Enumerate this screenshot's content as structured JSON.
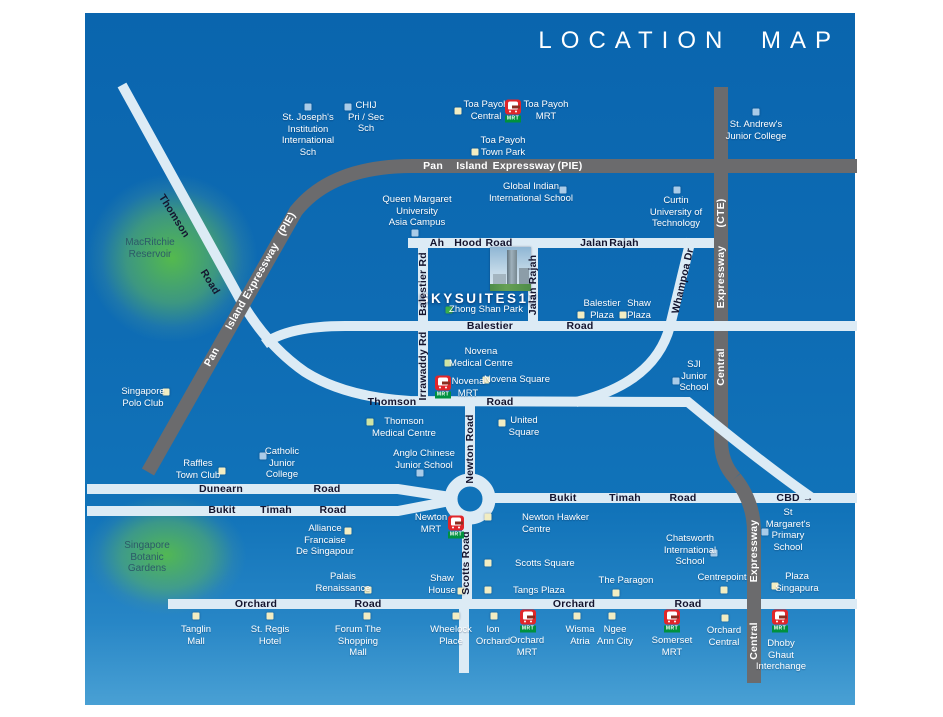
{
  "title": "LOCATION MAP",
  "project": {
    "name": "SKYSUITES17"
  },
  "mrt_badge": "MRT",
  "colors": {
    "background": "#0e6cb4",
    "road_minor": "#dcebf5",
    "expressway": "#6b6b6d",
    "marker_mall": "#f2edc2",
    "marker_school": "#a9cbe8",
    "marker_park": "#3bae4b",
    "marker_medical": "#cfe4a3",
    "mrt_red": "#e0262a",
    "mrt_green": "#00913e",
    "road_text": "#14142e",
    "label_text": "#ffffff",
    "green_area_text": "#2c5a68"
  },
  "map": {
    "green_areas": [
      {
        "id": "macritchie-reservoir",
        "lines": [
          "MacRitchie",
          "Reservoir"
        ],
        "x": 150,
        "y": 243
      },
      {
        "id": "singapore-botanic-gardens",
        "lines": [
          "Singapore",
          "Botanic",
          "Gardens"
        ],
        "x": 147,
        "y": 546
      }
    ],
    "road_labels": [
      {
        "t": "Pan",
        "x": 433,
        "y": 166,
        "c": "w"
      },
      {
        "t": "Island",
        "x": 472,
        "y": 166,
        "c": "w"
      },
      {
        "t": "Expressway",
        "x": 524,
        "y": 166,
        "c": "w"
      },
      {
        "t": "(PIE)",
        "x": 570,
        "y": 166,
        "c": "w"
      },
      {
        "t": "Pan",
        "x": 212,
        "y": 357,
        "rot": -61,
        "c": "w"
      },
      {
        "t": "Island",
        "x": 236,
        "y": 315,
        "rot": -61,
        "c": "w"
      },
      {
        "t": "Expressway",
        "x": 261,
        "y": 271,
        "rot": -61,
        "c": "w"
      },
      {
        "t": "(PIE)",
        "x": 287,
        "y": 224,
        "rot": -61,
        "c": "w"
      },
      {
        "t": "(CTE)",
        "x": 721,
        "y": 213,
        "rot": -90,
        "c": "w"
      },
      {
        "t": "Expressway",
        "x": 721,
        "y": 277,
        "rot": -90,
        "c": "w"
      },
      {
        "t": "Central",
        "x": 721,
        "y": 367,
        "rot": -90,
        "c": "w"
      },
      {
        "t": "Expressway",
        "x": 754,
        "y": 551,
        "rot": -90,
        "c": "w"
      },
      {
        "t": "Central",
        "x": 754,
        "y": 641,
        "rot": -90,
        "c": "w"
      },
      {
        "t": "Thomson",
        "x": 174,
        "y": 216,
        "rot": 58
      },
      {
        "t": "Road",
        "x": 210,
        "y": 282,
        "rot": 58
      },
      {
        "t": "Ah",
        "x": 437,
        "y": 243
      },
      {
        "t": "Hood",
        "x": 468,
        "y": 243
      },
      {
        "t": "Road",
        "x": 499,
        "y": 243
      },
      {
        "t": "Jalan",
        "x": 594,
        "y": 243
      },
      {
        "t": "Rajah",
        "x": 624,
        "y": 243
      },
      {
        "t": "Balestier Rd",
        "x": 423,
        "y": 284,
        "rot": -90
      },
      {
        "t": "Jalan Rajah",
        "x": 533,
        "y": 285,
        "rot": -90
      },
      {
        "t": "Whampoa Dr",
        "x": 683,
        "y": 281,
        "rot": -77
      },
      {
        "t": "Balestier",
        "x": 490,
        "y": 326
      },
      {
        "t": "Road",
        "x": 580,
        "y": 326
      },
      {
        "t": "Irrawaddy Rd",
        "x": 423,
        "y": 366,
        "rot": -90
      },
      {
        "t": "Thomson",
        "x": 392,
        "y": 402
      },
      {
        "t": "Road",
        "x": 500,
        "y": 402
      },
      {
        "t": "Newton Road",
        "x": 470,
        "y": 449,
        "rot": -90
      },
      {
        "t": "Dunearn",
        "x": 221,
        "y": 489
      },
      {
        "t": "Road",
        "x": 327,
        "y": 489
      },
      {
        "t": "Bukit",
        "x": 222,
        "y": 510
      },
      {
        "t": "Timah",
        "x": 276,
        "y": 510
      },
      {
        "t": "Road",
        "x": 333,
        "y": 510
      },
      {
        "t": "Bukit",
        "x": 563,
        "y": 498
      },
      {
        "t": "Timah",
        "x": 625,
        "y": 498
      },
      {
        "t": "Road",
        "x": 683,
        "y": 498
      },
      {
        "t": "CBD →",
        "x": 795,
        "y": 498
      },
      {
        "t": "Scotts Road",
        "x": 466,
        "y": 563,
        "rot": -90
      },
      {
        "t": "Orchard",
        "x": 256,
        "y": 604
      },
      {
        "t": "Road",
        "x": 368,
        "y": 604
      },
      {
        "t": "Orchard",
        "x": 574,
        "y": 604
      },
      {
        "t": "Road",
        "x": 688,
        "y": 604
      }
    ],
    "places": [
      {
        "id": "st-josephs-institution",
        "lines": [
          "St. Joseph's",
          "Institution",
          "International",
          "Sch"
        ],
        "x": 308,
        "y": 118,
        "mx": 308,
        "my": 107,
        "mc": "school"
      },
      {
        "id": "chij-pri-sec-sch",
        "lines": [
          "CHIJ",
          "Pri / Sec",
          "Sch"
        ],
        "x": 366,
        "y": 106,
        "mx": 348,
        "my": 107,
        "mc": "school"
      },
      {
        "id": "toa-payoh-central",
        "lines": [
          "Toa Payoh",
          "Central"
        ],
        "x": 486,
        "y": 105,
        "mx": 458,
        "my": 111,
        "mc": "mall"
      },
      {
        "id": "toa-payoh-town-park",
        "lines": [
          "Toa Payoh",
          "Town Park"
        ],
        "x": 503,
        "y": 141,
        "mx": 475,
        "my": 152,
        "mc": "mall"
      },
      {
        "id": "st-andrews-junior-college",
        "lines": [
          "St. Andrew's",
          "Junior College"
        ],
        "x": 756,
        "y": 125,
        "mx": 756,
        "my": 112,
        "mc": "school"
      },
      {
        "id": "global-indian-international-school",
        "lines": [
          "Global Indian",
          "International School"
        ],
        "x": 531,
        "y": 187,
        "mx": 563,
        "my": 190,
        "mc": "school"
      },
      {
        "id": "curtin-university-of-technology",
        "lines": [
          "Curtin",
          "University of",
          "Technology"
        ],
        "x": 676,
        "y": 201,
        "mx": 677,
        "my": 190,
        "mc": "school"
      },
      {
        "id": "queen-margaret-university",
        "lines": [
          "Queen Margaret",
          "University",
          "Asia Campus"
        ],
        "x": 417,
        "y": 200,
        "mx": 415,
        "my": 233,
        "mc": "school"
      },
      {
        "id": "balestier-plaza",
        "lines": [
          "Balestier",
          "Plaza"
        ],
        "x": 602,
        "y": 304,
        "mx": 581,
        "my": 315,
        "mc": "mall"
      },
      {
        "id": "shaw-plaza",
        "lines": [
          "Shaw",
          "Plaza"
        ],
        "x": 639,
        "y": 304,
        "mx": 623,
        "my": 315,
        "mc": "mall"
      },
      {
        "id": "zhong-shan-park",
        "lines": [
          "Zhong Shan Park"
        ],
        "x": 486,
        "y": 310,
        "mx": 449,
        "my": 310,
        "mc": "park"
      },
      {
        "id": "novena-medical-centre",
        "lines": [
          "Novena",
          "Medical Centre"
        ],
        "x": 481,
        "y": 352,
        "mx": 448,
        "my": 363,
        "mc": "medical"
      },
      {
        "id": "novena-square",
        "lines": [
          "Novena Square"
        ],
        "x": 517,
        "y": 380,
        "mx": 486,
        "my": 380,
        "mc": "mall"
      },
      {
        "id": "sji-junior-school",
        "lines": [
          "SJI",
          "Junior",
          "School"
        ],
        "x": 694,
        "y": 365,
        "mx": 676,
        "my": 381,
        "mc": "school"
      },
      {
        "id": "thomson-medical-centre",
        "lines": [
          "Thomson",
          "Medical Centre"
        ],
        "x": 404,
        "y": 422,
        "mx": 370,
        "my": 422,
        "mc": "medical"
      },
      {
        "id": "united-square",
        "lines": [
          "United",
          "Square"
        ],
        "x": 524,
        "y": 421,
        "mx": 502,
        "my": 423,
        "mc": "mall"
      },
      {
        "id": "anglo-chinese-junior-school",
        "lines": [
          "Anglo Chinese",
          "Junior School"
        ],
        "x": 424,
        "y": 454,
        "mx": 420,
        "my": 473,
        "mc": "school"
      },
      {
        "id": "newton-hawker-centre",
        "lines": [
          "Newton Hawker",
          "Centre"
        ],
        "x": 522,
        "y": 518,
        "align": "left",
        "mx": 488,
        "my": 517,
        "mc": "mall"
      },
      {
        "id": "scotts-square",
        "lines": [
          "Scotts Square"
        ],
        "x": 515,
        "y": 564,
        "align": "left",
        "mx": 488,
        "my": 563,
        "mc": "mall"
      },
      {
        "id": "tangs-plaza",
        "lines": [
          "Tangs Plaza"
        ],
        "x": 513,
        "y": 591,
        "align": "left",
        "mx": 488,
        "my": 590,
        "mc": "mall"
      },
      {
        "id": "shaw-house",
        "lines": [
          "Shaw",
          "House"
        ],
        "x": 442,
        "y": 579,
        "mx": 461,
        "my": 591,
        "mc": "mall"
      },
      {
        "id": "the-paragon",
        "lines": [
          "The Paragon"
        ],
        "x": 626,
        "y": 581,
        "mx": 616,
        "my": 593,
        "mc": "mall"
      },
      {
        "id": "centrepoint",
        "lines": [
          "Centrepoint"
        ],
        "x": 722,
        "y": 578,
        "mx": 724,
        "my": 590,
        "mc": "mall"
      },
      {
        "id": "chatsworth-international-school",
        "lines": [
          "Chatsworth",
          "International",
          "School"
        ],
        "x": 690,
        "y": 539,
        "mx": 714,
        "my": 553,
        "mc": "school"
      },
      {
        "id": "st-margarets-primary-school",
        "lines": [
          "St",
          "Margaret's",
          "Primary",
          "School"
        ],
        "x": 788,
        "y": 513,
        "mx": 765,
        "my": 532,
        "mc": "school"
      },
      {
        "id": "plaza-singapura",
        "lines": [
          "Plaza",
          "Singapura"
        ],
        "x": 797,
        "y": 577,
        "mx": 775,
        "my": 586,
        "mc": "mall"
      },
      {
        "id": "raffles-town-club",
        "lines": [
          "Raffles",
          "Town Club"
        ],
        "x": 198,
        "y": 464,
        "mx": 222,
        "my": 471,
        "mc": "mall"
      },
      {
        "id": "catholic-junior-college",
        "lines": [
          "Catholic",
          "Junior",
          "College"
        ],
        "x": 282,
        "y": 452,
        "mx": 263,
        "my": 456,
        "mc": "school"
      },
      {
        "id": "alliance-francaise-de-singapour",
        "lines": [
          "Alliance",
          "Francaise",
          "De Singapour"
        ],
        "x": 325,
        "y": 529,
        "mx": 348,
        "my": 531,
        "mc": "mall"
      },
      {
        "id": "palais-renaissance",
        "lines": [
          "Palais",
          "Renaissance"
        ],
        "x": 343,
        "y": 577,
        "mx": 368,
        "my": 590,
        "mc": "mall"
      },
      {
        "id": "singapore-polo-club",
        "lines": [
          "Singapore",
          "Polo Club"
        ],
        "x": 143,
        "y": 392,
        "mx": 166,
        "my": 392,
        "mc": "mall"
      },
      {
        "id": "tanglin-mall",
        "lines": [
          "Tanglin",
          "Mall"
        ],
        "x": 196,
        "y": 630,
        "mx": 196,
        "my": 616,
        "mc": "mall"
      },
      {
        "id": "st-regis-hotel",
        "lines": [
          "St. Regis",
          "Hotel"
        ],
        "x": 270,
        "y": 630,
        "mx": 270,
        "my": 616,
        "mc": "mall"
      },
      {
        "id": "forum-the-shopping-mall",
        "lines": [
          "Forum The",
          "Shopping",
          "Mall"
        ],
        "x": 358,
        "y": 630,
        "mx": 367,
        "my": 616,
        "mc": "mall"
      },
      {
        "id": "wheelock-place",
        "lines": [
          "Wheelock",
          "Place"
        ],
        "x": 451,
        "y": 630,
        "mx": 456,
        "my": 616,
        "mc": "mall"
      },
      {
        "id": "ion-orchard",
        "lines": [
          "Ion",
          "Orchard"
        ],
        "x": 493,
        "y": 630,
        "mx": 494,
        "my": 616,
        "mc": "mall"
      },
      {
        "id": "wisma-atria",
        "lines": [
          "Wisma",
          "Atria"
        ],
        "x": 580,
        "y": 630,
        "mx": 577,
        "my": 616,
        "mc": "mall"
      },
      {
        "id": "ngee-ann-city",
        "lines": [
          "Ngee",
          "Ann City"
        ],
        "x": 615,
        "y": 630,
        "mx": 612,
        "my": 616,
        "mc": "mall"
      },
      {
        "id": "orchard-central",
        "lines": [
          "Orchard",
          "Central"
        ],
        "x": 724,
        "y": 631,
        "mx": 725,
        "my": 618,
        "mc": "mall"
      }
    ],
    "mrt_stations": [
      {
        "id": "toa-payoh-mrt",
        "lines": [
          "Toa Payoh",
          "MRT"
        ],
        "ix": 513,
        "iy": 111,
        "lx": 546,
        "ly": 105
      },
      {
        "id": "novena-mrt",
        "lines": [
          "Novena",
          "MRT"
        ],
        "ix": 443,
        "iy": 387,
        "lx": 468,
        "ly": 382
      },
      {
        "id": "newton-mrt",
        "lines": [
          "Newton",
          "MRT"
        ],
        "ix": 456,
        "iy": 527,
        "lx": 431,
        "ly": 518
      },
      {
        "id": "orchard-mrt",
        "lines": [
          "Orchard",
          "MRT"
        ],
        "ix": 528,
        "iy": 621,
        "lx": 527,
        "ly": 641
      },
      {
        "id": "somerset-mrt",
        "lines": [
          "Somerset",
          "MRT"
        ],
        "ix": 672,
        "iy": 621,
        "lx": 672,
        "ly": 641
      },
      {
        "id": "dhoby-ghaut-interchange",
        "lines": [
          "Dhoby",
          "Ghaut",
          "Interchange"
        ],
        "ix": 780,
        "iy": 621,
        "lx": 781,
        "ly": 644
      }
    ]
  }
}
